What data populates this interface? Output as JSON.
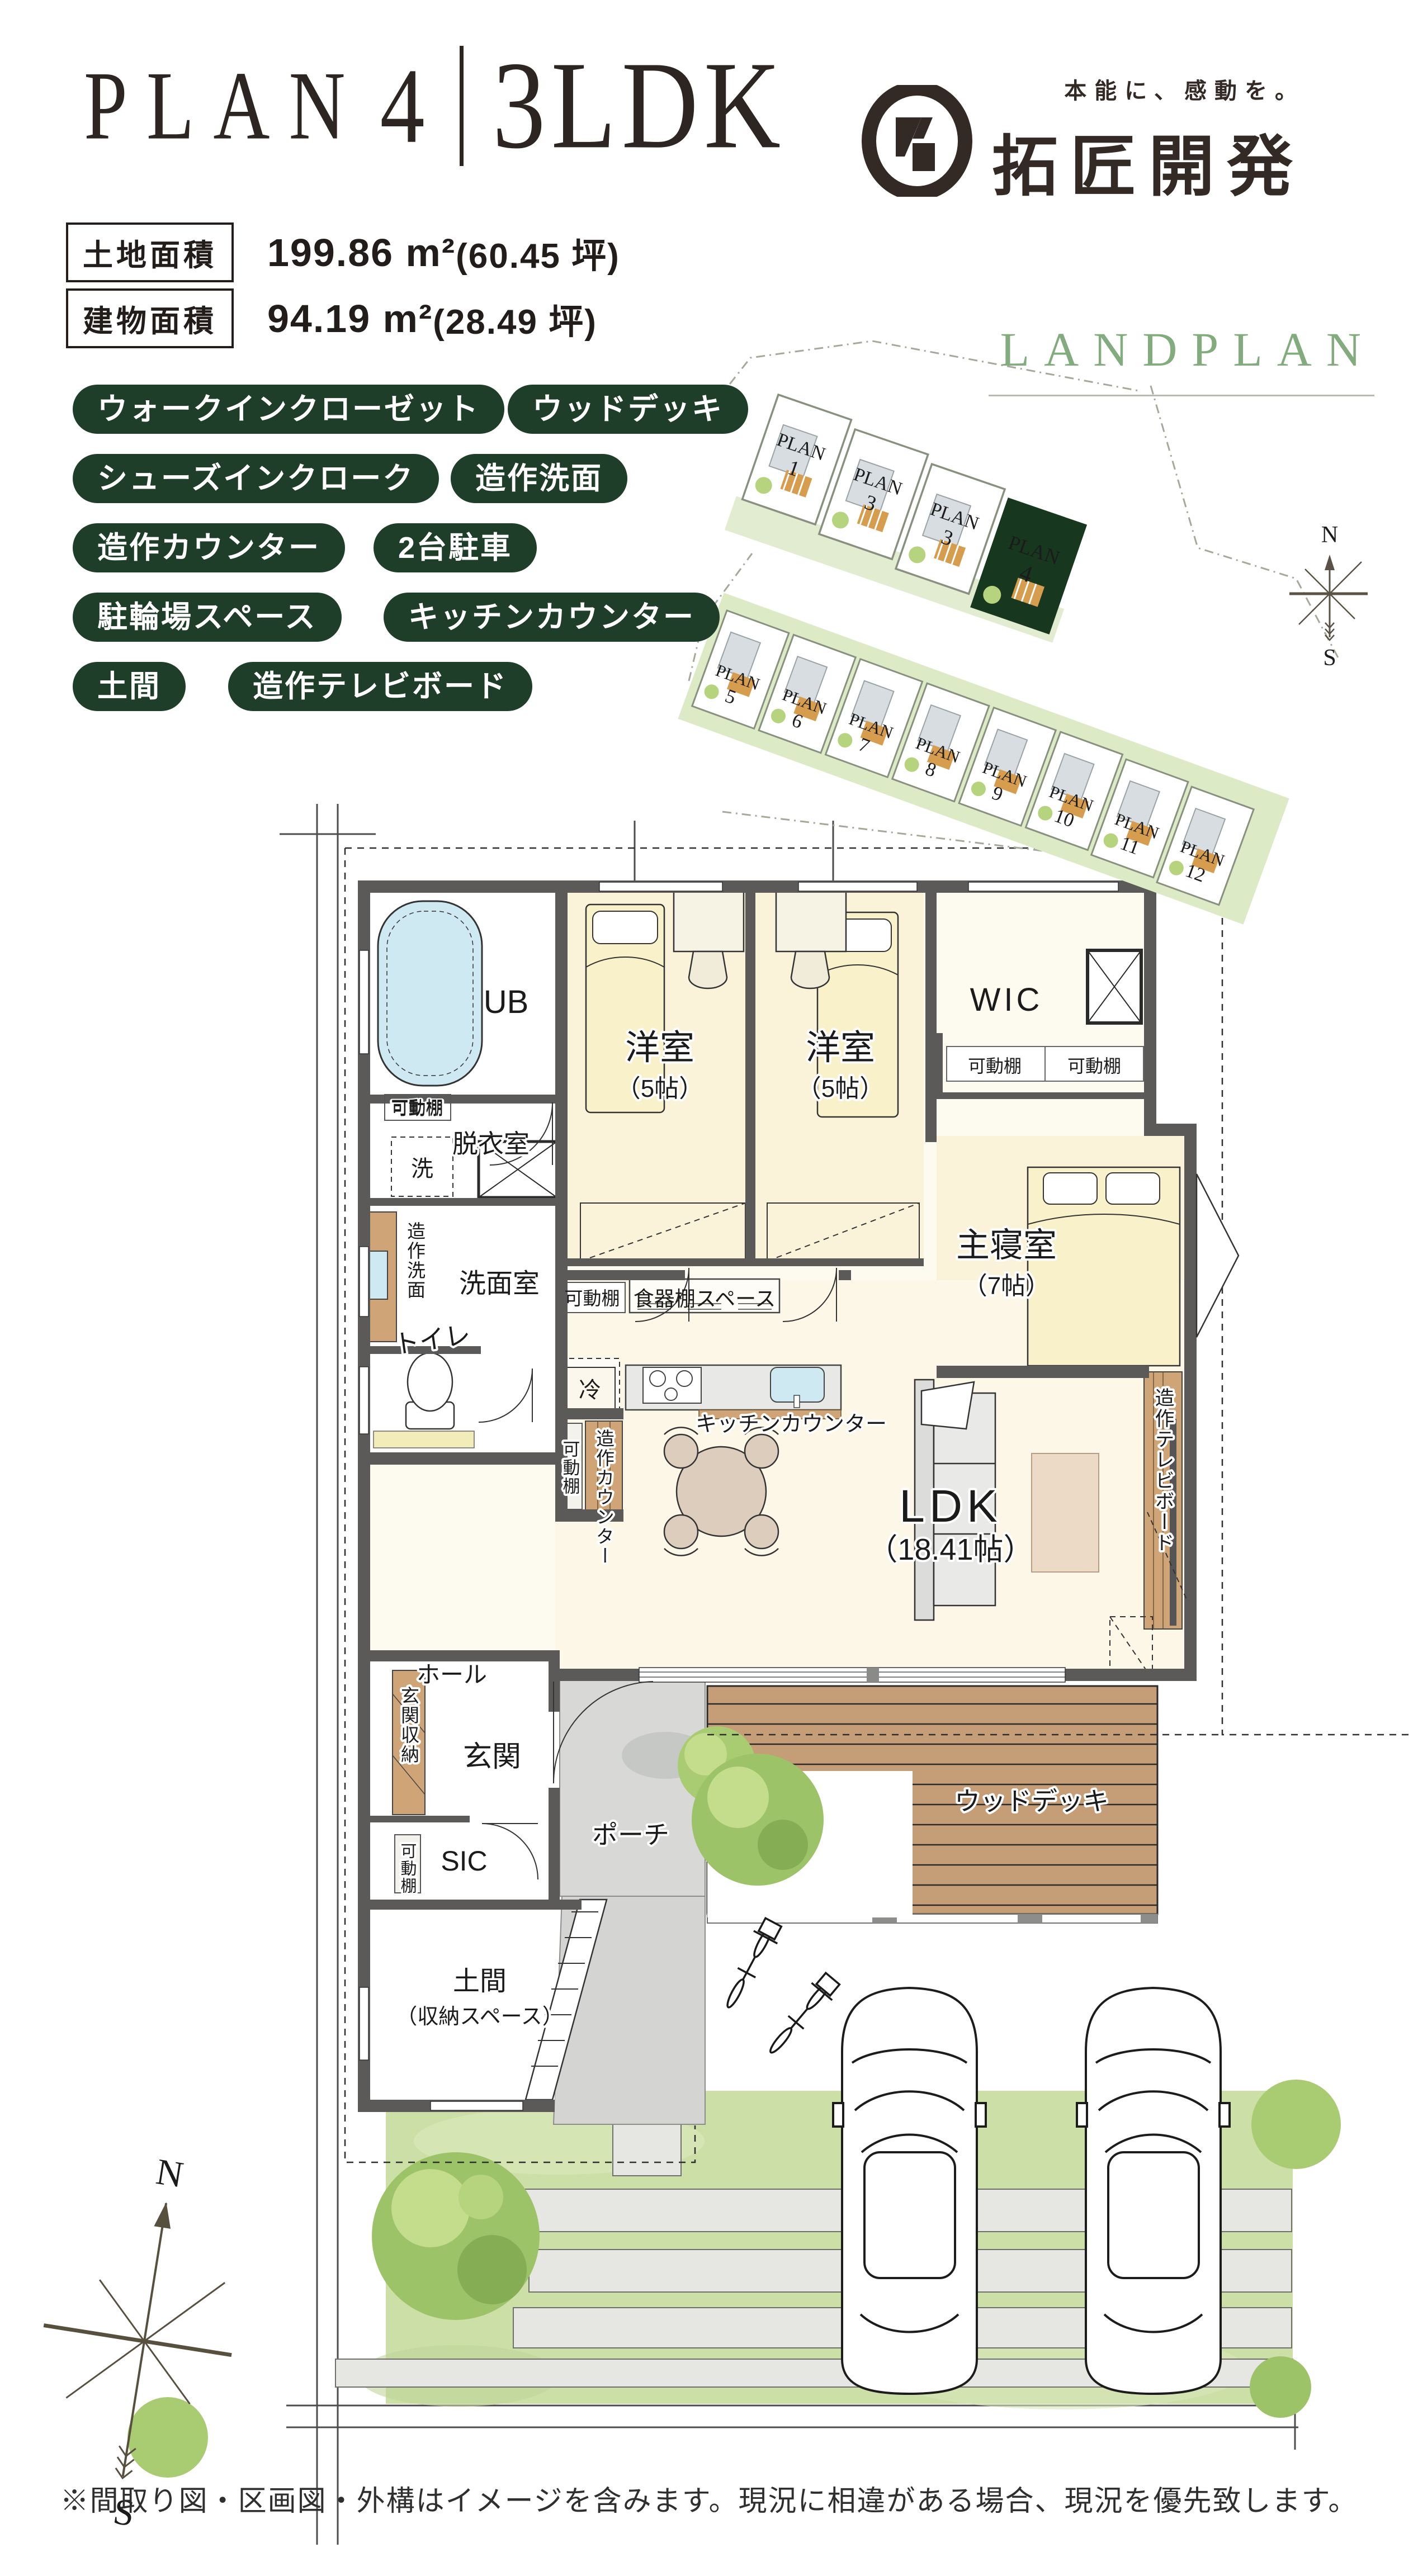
{
  "header": {
    "plan_word": "PLAN",
    "plan_number": "4",
    "plan_type": "3LDK"
  },
  "logo": {
    "tagline": "本能に、感動を。",
    "company": "拓匠開発"
  },
  "areas": [
    {
      "label": "土地面積",
      "value": "199.86 m²",
      "tsubo": "(60.45 坪)"
    },
    {
      "label": "建物面積",
      "value": "94.19 m²",
      "tsubo": "(28.49 坪)"
    }
  ],
  "features": [
    "ウォークインクローゼット",
    "ウッドデッキ",
    "シューズインクローク",
    "造作洗面",
    "造作カウンター",
    "2台駐車",
    "駐輪場スペース",
    "キッチンカウンター",
    "土間",
    "造作テレビボード"
  ],
  "landplan": {
    "title": "LANDPLAN",
    "plan_word": "PLAN",
    "top_lots": [
      "1",
      "3",
      "3",
      "4"
    ],
    "bottom_lots": [
      "5",
      "6",
      "7",
      "8",
      "9",
      "10",
      "11",
      "12"
    ],
    "highlighted_lot": "4",
    "compass_n": "N",
    "compass_s": "S"
  },
  "floorplan": {
    "ub": "UB",
    "kado": "可動棚",
    "datsui": "脱衣室",
    "sen": "洗",
    "zosaku_senmen": "造作洗面",
    "senmen": "洗面室",
    "toilet": "トイレ",
    "yoshitsu": "洋室",
    "yoshitsu_size": "（5帖）",
    "wic": "WIC",
    "shushin": "主寝室",
    "shushin_size": "（7帖）",
    "shokki": "食器棚スペース",
    "rei": "冷",
    "kitchen_counter": "キッチンカウンター",
    "zosaku_counter": "造作カウンター",
    "ldk": "LDK",
    "ldk_size": "（18.41帖）",
    "tv": "造作テレビボード",
    "hall": "ホール",
    "genkan_shuno": "玄関収納",
    "genkan": "玄関",
    "sic": "SIC",
    "porch": "ポーチ",
    "doma": "土間",
    "doma_sub": "（収納スペース）",
    "deck": "ウッドデッキ",
    "compass_n": "N",
    "compass_s": "S"
  },
  "footer": {
    "disclaimer": "※間取り図・区画図・外構はイメージを含みます。現況に相違がある場合、現況を優先致します。"
  },
  "colors": {
    "accent_green": "#1f3e29",
    "landplan_green": "#82ab7e",
    "highlight_lot": "#17381f",
    "wall_gray": "#5c5a58",
    "wood": "#cfa577",
    "deck": "#c59d77",
    "lawn": "#cbdfa6",
    "porch_gray": "#d8d8d6",
    "bed_yellow": "#f8f1ca",
    "water_blue": "#cfe9f3",
    "stone_gray": "#e6e6e2"
  }
}
